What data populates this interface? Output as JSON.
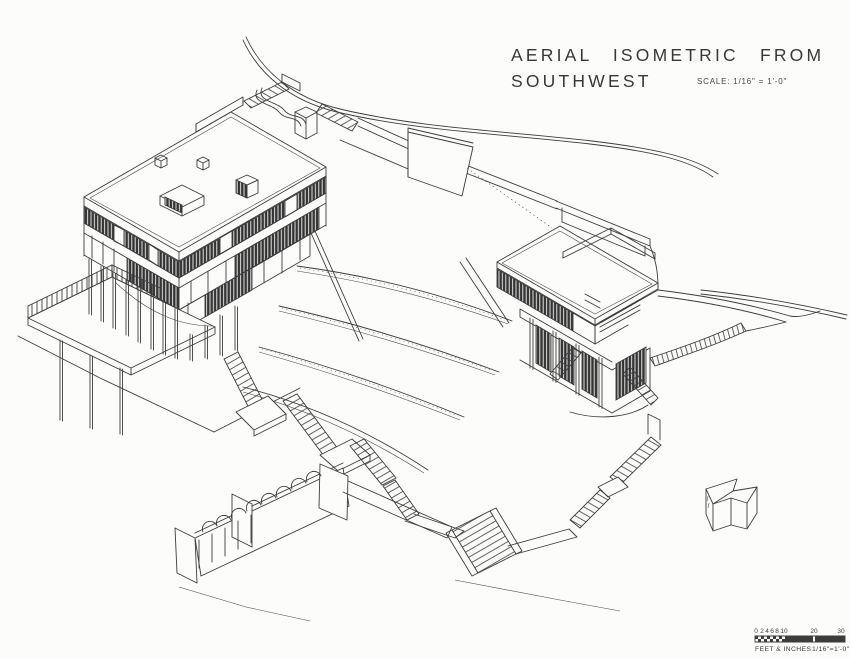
{
  "title": {
    "line1": "AERIAL ISOMETRIC FROM",
    "line2": "SOUTHWEST",
    "scale_note": "SCALE:  1/16\" = 1'-0\""
  },
  "scale_bar": {
    "ticks": [
      "0",
      "2",
      "4",
      "6",
      "8",
      "10",
      "20",
      "30"
    ],
    "units_label": "FEET & INCHES",
    "ratio_label": "1/16\"=1'-0\""
  },
  "colors": {
    "paper": "#fcfcfb",
    "ink": "#3c3c3c",
    "glazing_dark": "#343434"
  },
  "drawing": {
    "view": "aerial isometric architectural line drawing",
    "elements": [
      "hillside-contour",
      "main-house",
      "roof-terrace",
      "ribbon-windows",
      "pilotis",
      "terrace-deck-with-railing",
      "garden-stairs",
      "curved-garden-terraces",
      "pergola-arcade",
      "guest-pavilion",
      "curved-garden-stair",
      "north-arrow"
    ]
  }
}
